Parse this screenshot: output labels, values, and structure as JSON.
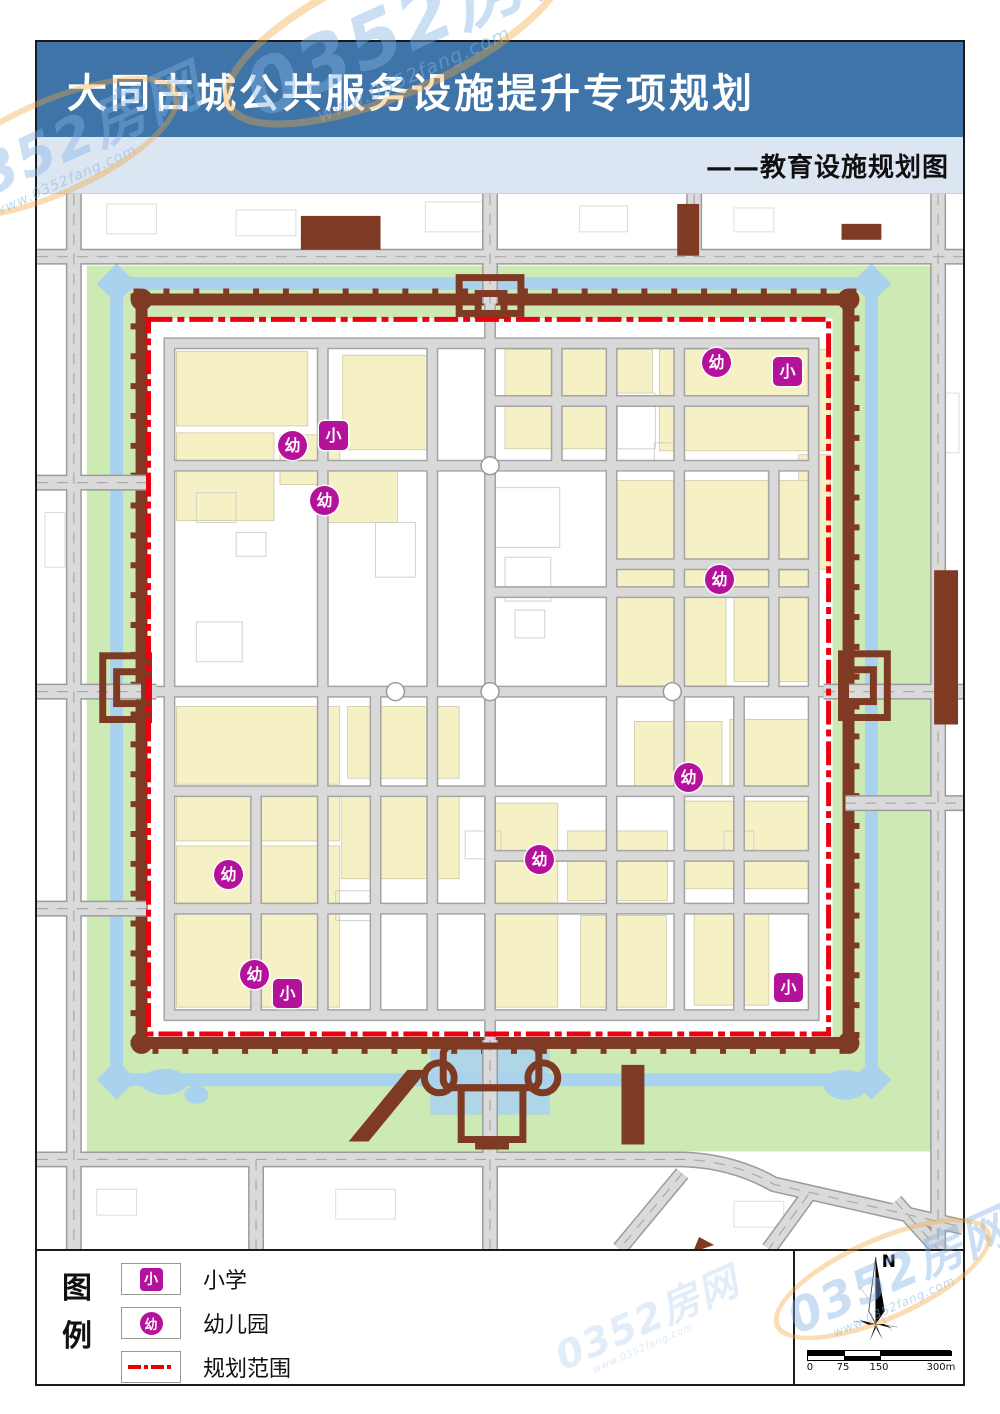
{
  "header": {
    "title": "大同古城公共服务设施提升专项规划",
    "subtitle": "——教育设施规划图"
  },
  "legend": {
    "title_chars": "图例",
    "items": [
      {
        "symbol": "小",
        "shape": "square",
        "label": "小学"
      },
      {
        "symbol": "幼",
        "shape": "circle",
        "label": "幼儿园"
      },
      {
        "symbol": "",
        "shape": "dash-dot-line",
        "label": "规划范围"
      }
    ]
  },
  "compass": {
    "label": "N"
  },
  "scale_bar": {
    "labels": [
      "0",
      "75",
      "150",
      "300m"
    ]
  },
  "watermark": {
    "text": "0352房网",
    "url": "www.0352fang.com"
  },
  "colors": {
    "header_blue": "#3e74a8",
    "subband_blue": "#dce6f3",
    "marker_magenta": "#b5129b",
    "boundary_red": "#ec0010",
    "wall_brown": "#7e3a22",
    "moat_blue": "#a9d2ee",
    "greenbelt": "#cdeab4",
    "block_yellow": "#f6f1c4",
    "road_gray": "#d9d9d9"
  },
  "map": {
    "markers": [
      {
        "type": "kindergarten",
        "symbol": "幼",
        "x": 679,
        "y": 168
      },
      {
        "type": "primary_school",
        "symbol": "小",
        "x": 750,
        "y": 177
      },
      {
        "type": "kindergarten",
        "symbol": "幼",
        "x": 255,
        "y": 251
      },
      {
        "type": "primary_school",
        "symbol": "小",
        "x": 296,
        "y": 241
      },
      {
        "type": "kindergarten",
        "symbol": "幼",
        "x": 287,
        "y": 306
      },
      {
        "type": "kindergarten",
        "symbol": "幼",
        "x": 682,
        "y": 385
      },
      {
        "type": "kindergarten",
        "symbol": "幼",
        "x": 651,
        "y": 583
      },
      {
        "type": "kindergarten",
        "symbol": "幼",
        "x": 502,
        "y": 665
      },
      {
        "type": "kindergarten",
        "symbol": "幼",
        "x": 191,
        "y": 680
      },
      {
        "type": "kindergarten",
        "symbol": "幼",
        "x": 217,
        "y": 780
      },
      {
        "type": "primary_school",
        "symbol": "小",
        "x": 250,
        "y": 799
      },
      {
        "type": "primary_school",
        "symbol": "小",
        "x": 751,
        "y": 793
      }
    ]
  }
}
